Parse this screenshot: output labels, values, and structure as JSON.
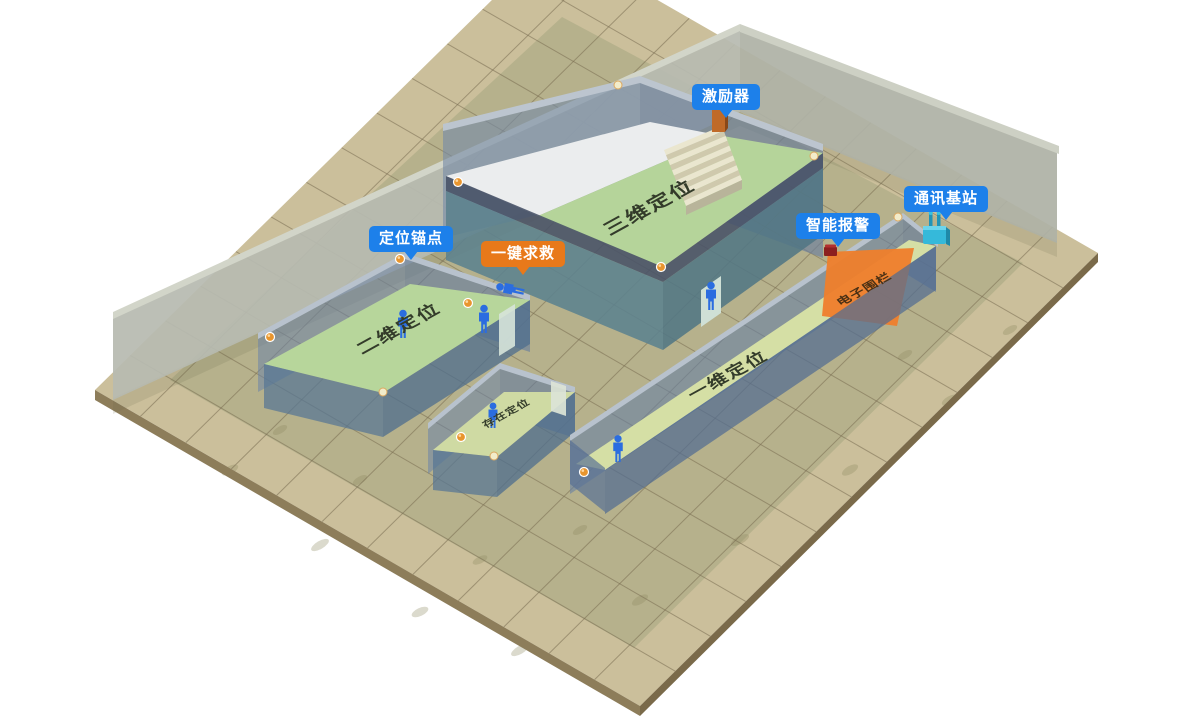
{
  "callouts": {
    "exciter": {
      "label": "激励器",
      "color": "#1d80ea"
    },
    "base_station": {
      "label": "通讯基站",
      "color": "#1d80ea"
    },
    "smart_alarm": {
      "label": "智能报警",
      "color": "#1d80ea"
    },
    "anchor": {
      "label": "定位锚点",
      "color": "#1d80ea"
    },
    "sos": {
      "label": "一键求救",
      "color": "#e8791a"
    }
  },
  "zones": {
    "zone_3d": {
      "label": "三维定位",
      "floor_color": "#b5d49a"
    },
    "zone_2d": {
      "label": "二维定位",
      "floor_color": "#b7d69b"
    },
    "zone_presence": {
      "label": "存在定位",
      "floor_color": "#cfdaa3"
    },
    "zone_1d": {
      "label": "一维定位",
      "floor_color": "#d5dfa5"
    },
    "fence": {
      "label": "电子围栏",
      "color": "#ee7f2d"
    }
  },
  "colors": {
    "background": "#ffffff",
    "floor_tile": "#cbbf9b",
    "floor_tile_inner": "#b0ae88",
    "floor_edge": "#8d7d5a",
    "back_wall_gray": "#b7bab0",
    "room_wall_blue": "#7089a8",
    "wall_rim_light": "#b8c2cd",
    "lower_wall_teal": "#5f91a0",
    "upper_floor_white": "#ebedee",
    "stair_light": "#eae6cf",
    "stair_dark": "#cfc9ad",
    "person_blue": "#2b6de0",
    "anchor_dot_orange": "#e8952e",
    "anchor_dot_pale": "#f2ecca",
    "exciter_device": "#c06a28",
    "alarm_device": "#8c1f1f",
    "station_device": "#35b9da"
  },
  "icons": {
    "person": "person-icon",
    "anchor_dot": "anchor-dot-icon",
    "exciter": "exciter-device-icon",
    "alarm": "alarm-device-icon",
    "station": "antenna-station-icon"
  }
}
